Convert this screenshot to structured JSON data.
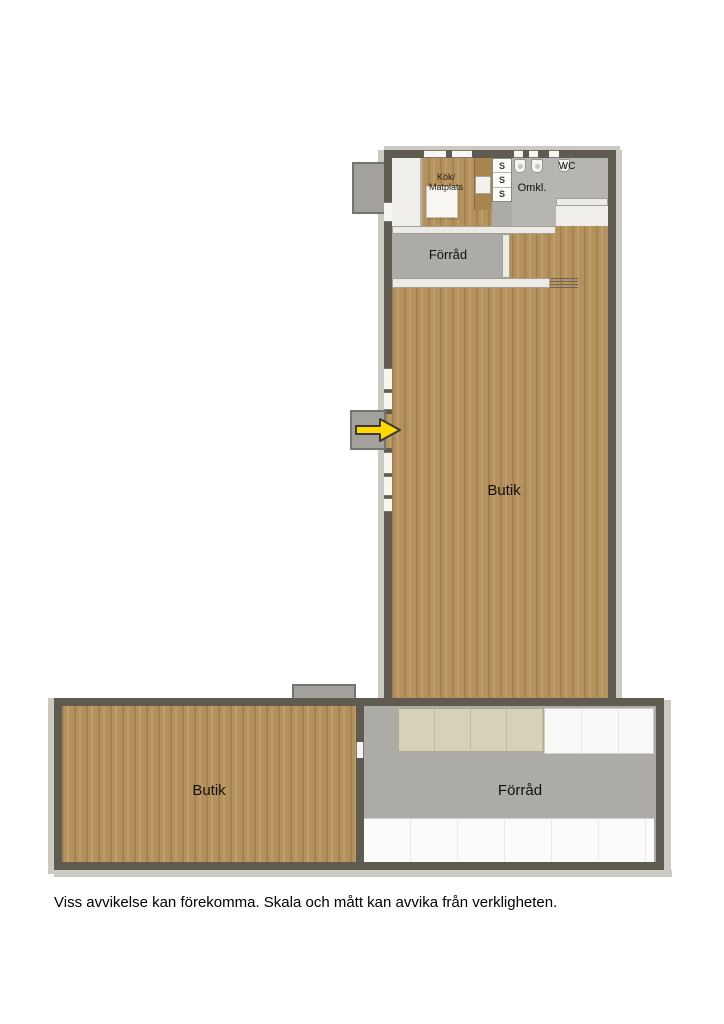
{
  "page": {
    "disclaimer": "Viss avvikelse kan förekomma. Skala och mått kan avvika från verkligheten."
  },
  "palette": {
    "wall_dark": "#5f5b51",
    "wall_light": "#edebe6",
    "wood_floor": "#b5915e",
    "gray_floor": "#acaba8",
    "shelf_beige": "#d8d1ba",
    "shelf_white": "#f9f9f7",
    "entry_gray": "#a2a19d",
    "arrow_yellow": "#ffd900",
    "background": "#ffffff"
  },
  "icons": {
    "entrance_arrow": "right-arrow"
  },
  "rooms": {
    "kitchen": {
      "label_line1": "Kök/",
      "label_line2": "Matplats"
    },
    "lockers": {
      "cells": [
        "S",
        "S",
        "S"
      ]
    },
    "changing_room": {
      "label": "Omkl."
    },
    "wc": {
      "label": "WC"
    },
    "storage_upper": {
      "label": "Förråd"
    },
    "shop_main": {
      "label": "Butik"
    },
    "shop_lower": {
      "label": "Butik"
    },
    "storage_lower": {
      "label": "Förråd"
    }
  }
}
